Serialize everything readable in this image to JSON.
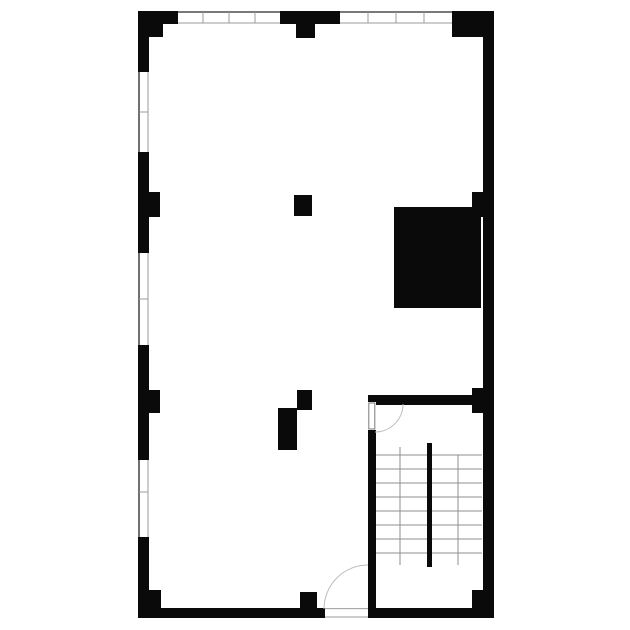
{
  "colors": {
    "wall": "#0a0a0a",
    "background": "#ffffff",
    "window_outer": "#4d4d4d",
    "window_inner": "#9b9b9b",
    "tick": "#9b9b9b",
    "tread": "#8f8f8f",
    "arc": "#bdbdbd",
    "leaf": "#7a7a7a",
    "threshold": "#9b9b9b"
  },
  "canvas": {
    "width": 630,
    "height": 630
  },
  "plan": {
    "walls": [
      {
        "name": "top-wall-left-segment",
        "x": 138,
        "y": 11,
        "w": 40,
        "h": 13
      },
      {
        "name": "top-wall-center-segment",
        "x": 280,
        "y": 11,
        "w": 60,
        "h": 13
      },
      {
        "name": "top-wall-right-segment",
        "x": 452,
        "y": 11,
        "w": 42,
        "h": 13
      },
      {
        "name": "left-wall-segment-1",
        "x": 138,
        "y": 11,
        "w": 11,
        "h": 61
      },
      {
        "name": "left-wall-segment-2",
        "x": 138,
        "y": 152,
        "w": 11,
        "h": 101
      },
      {
        "name": "left-wall-segment-3",
        "x": 138,
        "y": 345,
        "w": 11,
        "h": 115
      },
      {
        "name": "left-wall-segment-4",
        "x": 138,
        "y": 537,
        "w": 11,
        "h": 81
      },
      {
        "name": "right-wall",
        "x": 483,
        "y": 11,
        "w": 11,
        "h": 607
      },
      {
        "name": "bottom-wall-left-segment",
        "x": 138,
        "y": 608,
        "w": 187,
        "h": 10
      },
      {
        "name": "bottom-wall-right-segment",
        "x": 368,
        "y": 608,
        "w": 126,
        "h": 10
      },
      {
        "name": "stairwell-left-wall-upper",
        "x": 368,
        "y": 395,
        "w": 8,
        "h": 7
      },
      {
        "name": "stairwell-left-wall-lower",
        "x": 368,
        "y": 430,
        "w": 8,
        "h": 180
      },
      {
        "name": "stairwell-top-wall",
        "x": 368,
        "y": 395,
        "w": 104,
        "h": 10
      }
    ],
    "columns": [
      {
        "name": "column-top-left",
        "x": 138,
        "y": 11,
        "w": 25,
        "h": 26
      },
      {
        "name": "column-top-center",
        "x": 296,
        "y": 11,
        "w": 19,
        "h": 27
      },
      {
        "name": "column-top-right",
        "x": 452,
        "y": 11,
        "w": 42,
        "h": 26
      },
      {
        "name": "column-left-upper",
        "x": 138,
        "y": 192,
        "w": 22,
        "h": 25
      },
      {
        "name": "column-left-lower",
        "x": 138,
        "y": 390,
        "w": 22,
        "h": 23
      },
      {
        "name": "column-right-upper",
        "x": 472,
        "y": 192,
        "w": 22,
        "h": 25
      },
      {
        "name": "column-stair-corner",
        "x": 472,
        "y": 388,
        "w": 22,
        "h": 25
      },
      {
        "name": "column-center",
        "x": 294,
        "y": 195,
        "w": 18,
        "h": 21
      },
      {
        "name": "column-lower-center-a",
        "x": 297,
        "y": 390,
        "w": 15,
        "h": 20
      },
      {
        "name": "column-lower-center-b",
        "x": 278,
        "y": 408,
        "w": 19,
        "h": 42
      },
      {
        "name": "column-bottom-left",
        "x": 138,
        "y": 590,
        "w": 23,
        "h": 28
      },
      {
        "name": "column-bottom-center",
        "x": 300,
        "y": 592,
        "w": 17,
        "h": 26
      },
      {
        "name": "column-bottom-right",
        "x": 472,
        "y": 590,
        "w": 22,
        "h": 28
      }
    ],
    "solids": [
      {
        "name": "shaft-block",
        "x": 394,
        "y": 207,
        "w": 87,
        "h": 101
      }
    ],
    "windows": [
      {
        "name": "window-top-1",
        "orient": "h",
        "x": 178,
        "y": 11,
        "len": 102,
        "th": 13,
        "ticks": [
          203,
          229,
          255
        ]
      },
      {
        "name": "window-top-2",
        "orient": "h",
        "x": 340,
        "y": 11,
        "len": 112,
        "th": 13,
        "ticks": [
          368,
          396,
          424
        ]
      },
      {
        "name": "window-left-1",
        "orient": "v",
        "x": 138,
        "y": 72,
        "len": 80,
        "th": 11,
        "ticks": [
          112
        ]
      },
      {
        "name": "window-left-2",
        "orient": "v",
        "x": 138,
        "y": 253,
        "len": 92,
        "th": 11,
        "ticks": [
          299
        ]
      },
      {
        "name": "window-left-3",
        "orient": "v",
        "x": 138,
        "y": 460,
        "len": 77,
        "th": 11,
        "ticks": [
          492
        ]
      }
    ],
    "doors": [
      {
        "name": "stairwell-door",
        "gap": {
          "x": 368,
          "y": 402,
          "w": 8,
          "h": 28
        },
        "leaf": {
          "x": 368.8,
          "y": 403,
          "w": 6,
          "h": 26
        },
        "arc": "M 403 404 A 28 28 0 0 1 375 432"
      },
      {
        "name": "entry-door",
        "gap": {
          "x": 325,
          "y": 608,
          "w": 43,
          "h": 10
        },
        "threshold": [
          {
            "x1": 325,
            "y1": 608.6,
            "x2": 368,
            "y2": 608.6
          },
          {
            "x1": 325,
            "y1": 617,
            "x2": 368,
            "y2": 617
          }
        ],
        "arc": "M 324 609 A 44 44 0 0 1 368 565"
      }
    ],
    "stair": {
      "treads": {
        "x1": 376,
        "x2": 482,
        "ys": [
          455,
          469,
          483,
          497,
          511,
          525,
          539,
          553
        ]
      },
      "rails": [
        {
          "name": "stair-rail-left",
          "x": 400,
          "y1": 447,
          "y2": 565
        },
        {
          "name": "stair-rail-right",
          "x": 458,
          "y1": 455,
          "y2": 565
        }
      ],
      "divider": {
        "name": "stair-divider",
        "x": 427,
        "y": 443,
        "w": 5,
        "h": 124
      }
    }
  }
}
